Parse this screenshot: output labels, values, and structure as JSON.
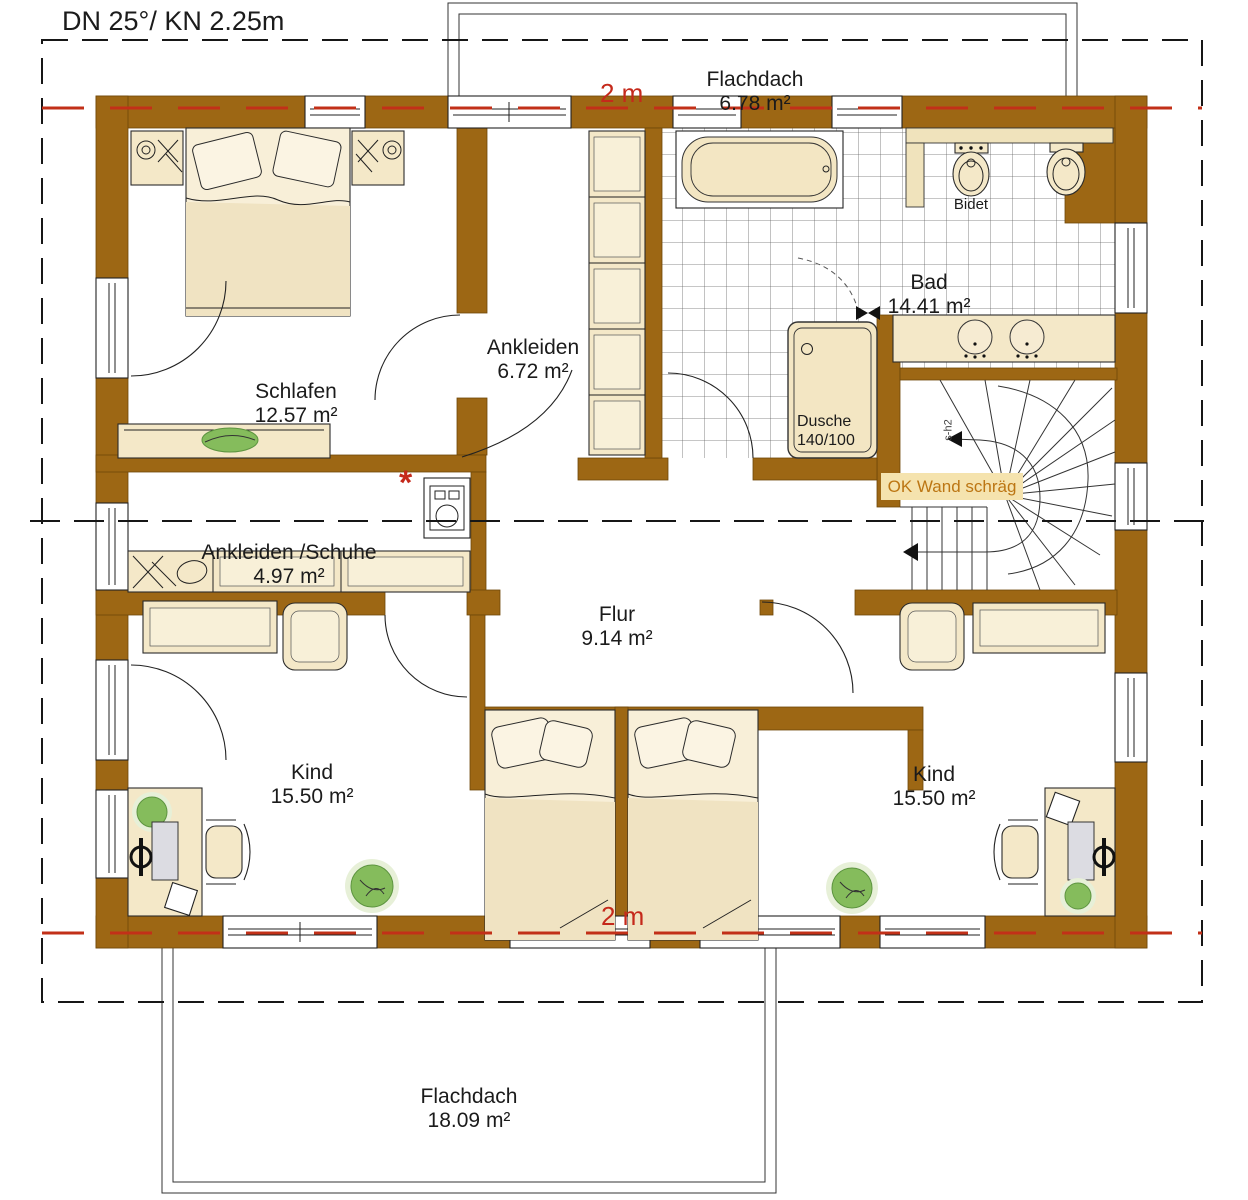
{
  "title": "DN 25°/ KN 2.25m",
  "marks": {
    "top": "2 m",
    "bottom": "2 m"
  },
  "roof": {
    "top": {
      "label": "Flachdach",
      "area": "6.78 m²"
    },
    "bottom": {
      "label": "Flachdach",
      "area": "18.09 m²"
    }
  },
  "rooms": [
    {
      "name": "Schlafen",
      "area": "12.57 m²"
    },
    {
      "name": "Ankleiden",
      "area": "6.72 m²"
    },
    {
      "name": "Bad",
      "area": "14.41 m²"
    },
    {
      "name": "Ankleiden /Schuhe",
      "area": "4.97 m²"
    },
    {
      "name": "Flur",
      "area": "9.14 m²"
    },
    {
      "name": "Kind",
      "area": "15.50 m²"
    },
    {
      "name": "Kind",
      "area": "15.50 m²"
    }
  ],
  "fixtures": {
    "dusche": {
      "label": "Dusche",
      "size": "140/100"
    },
    "bidet": "Bidet",
    "stair_note": "OK Wand schräg",
    "stair_code": "s-h2",
    "required_marker": "*"
  },
  "colors": {
    "wall": "#9D6714",
    "accent_red": "#C5291B",
    "note_bg": "#F5E3AE",
    "note_text": "#BC7613",
    "furniture": "#F4E8C8",
    "plant": "#85BC5C"
  }
}
